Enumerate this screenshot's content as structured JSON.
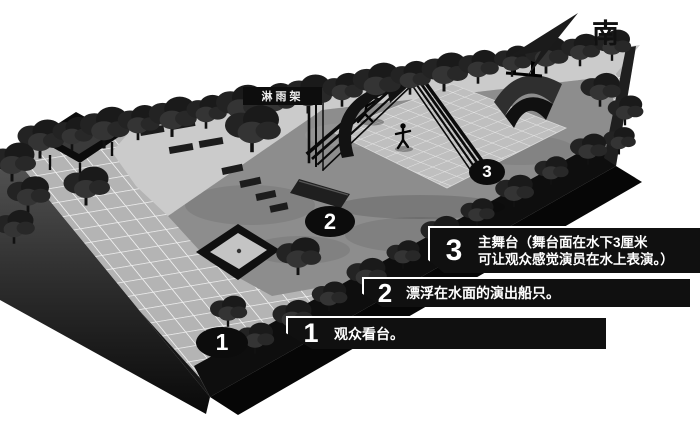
{
  "compass": {
    "label": "南"
  },
  "labels": {
    "rain_frame": "淋雨架"
  },
  "markers": [
    {
      "number": "1"
    },
    {
      "number": "2"
    },
    {
      "number": "3"
    }
  ],
  "annotations": [
    {
      "number": "3",
      "text1": "主舞台（舞台面在水下3厘米",
      "text2": "可让观众感觉演员在水上表演。）"
    },
    {
      "number": "2",
      "text1": "漂浮在水面的演出船只。"
    },
    {
      "number": "1",
      "text1": "观众看台。"
    }
  ],
  "colors": {
    "background": "#ffffff",
    "annotation_bar": "#101010",
    "annotation_text": "#ffffff",
    "water": "#8d8d8d",
    "walkway": "#cbcbcb",
    "plaza_tile": "#b4b4b4",
    "ink": "#111111"
  }
}
